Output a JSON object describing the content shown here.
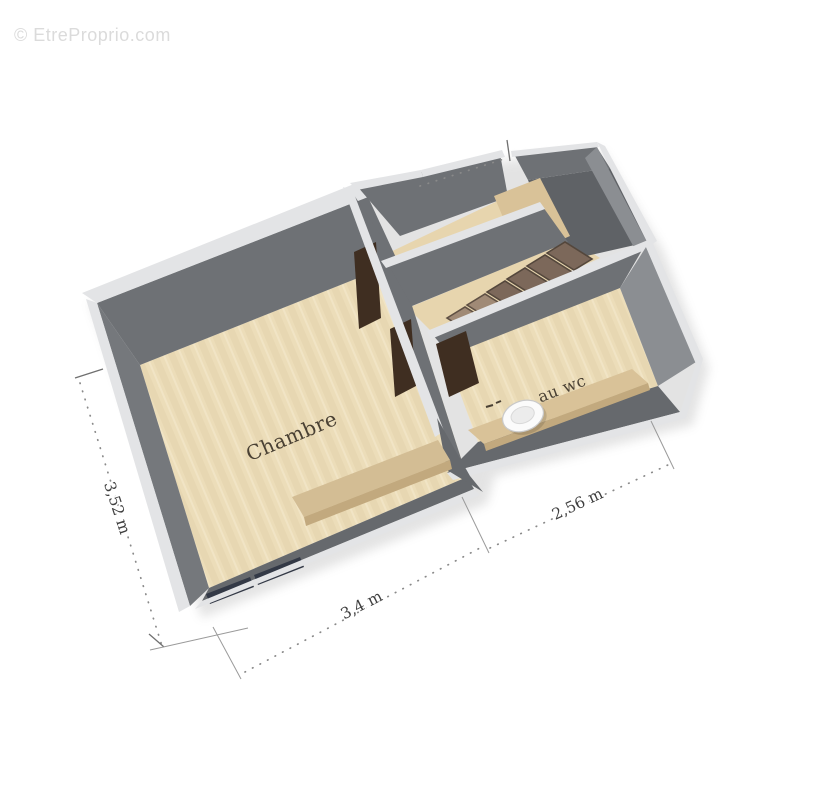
{
  "watermark": {
    "text": "© EtreProprio.com"
  },
  "plan": {
    "type": "3d-floor-plan",
    "rooms": {
      "chambre": {
        "label": "Chambre"
      },
      "wc": {
        "label": "au wc"
      }
    },
    "features": [
      "staircase",
      "toilet",
      "doors",
      "windows",
      "sideboard",
      "counter",
      "landing"
    ],
    "dimensions": {
      "left": "3,52 m",
      "bottom": "3,4 m",
      "right": "2,56 m"
    }
  },
  "colors": {
    "floor": "#ecddb9",
    "floor_alt": "#e7d5ae",
    "wall_face": "#6e7175",
    "wall_face_light": "#8b8e92",
    "wall_top": "#e3e4e6",
    "stair_top": "#7c685a",
    "stair_riser": "#5f5044",
    "door": "#3f2e21",
    "window": "#333946",
    "furniture": "#d9c298",
    "dimension_text": "#4a4134",
    "watermark": "#dbdbdb"
  }
}
